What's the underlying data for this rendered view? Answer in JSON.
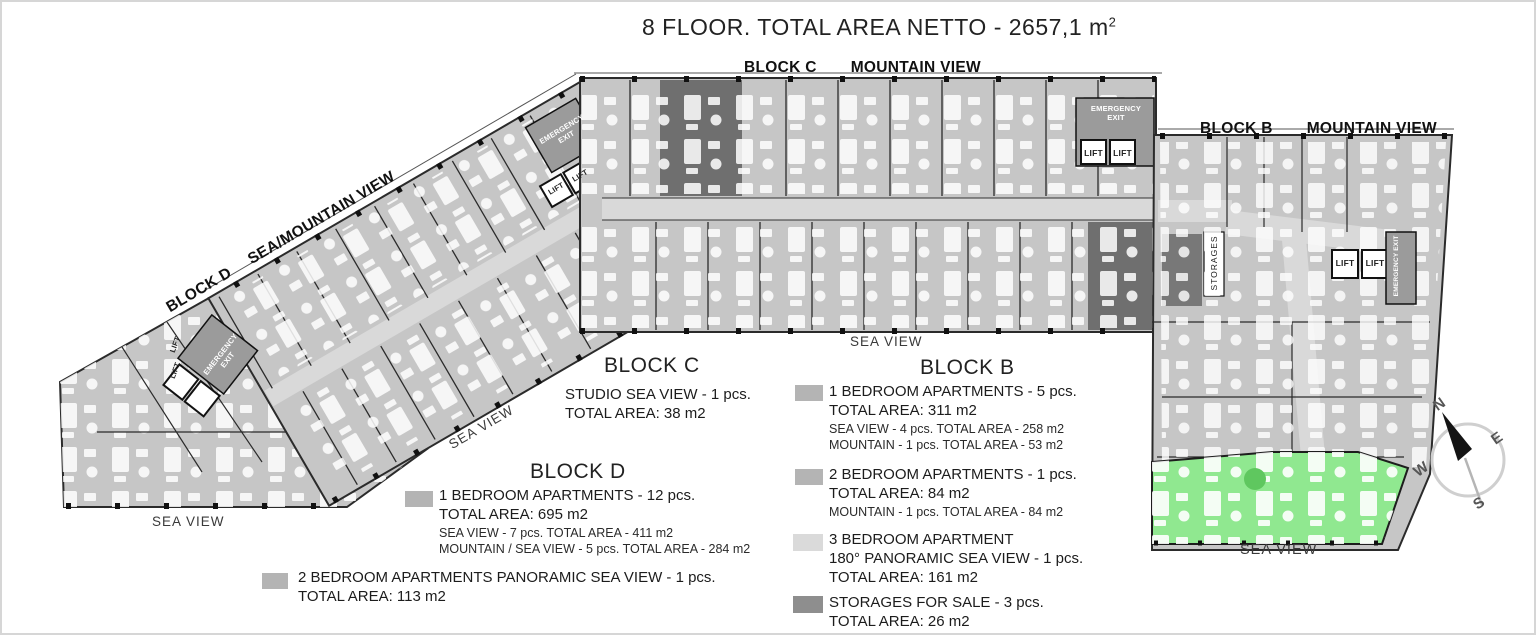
{
  "title": {
    "text": "8 FLOOR. TOTAL AREA NETTO - 2657,1 m",
    "sup": "2"
  },
  "plan": {
    "block_c_label": "BLOCK C",
    "block_c_view": "MOUNTAIN VIEW",
    "block_b_label": "BLOCK B",
    "block_b_view": "MOUNTAIN VIEW",
    "block_d_label": "BLOCK D",
    "block_d_view": "SEA/MOUNTAIN VIEW",
    "sea_view": "SEA VIEW",
    "emergency_exit": "EMERGENCY EXIT",
    "lift": "LIFT",
    "storages": "STORAGES"
  },
  "compass": {
    "n": "N",
    "e": "E",
    "s": "S",
    "w": "W"
  },
  "legends": {
    "block_c": {
      "title": "BLOCK C",
      "line1": "STUDIO SEA VIEW - 1 pcs.",
      "line2": "TOTAL AREA: 38 m2"
    },
    "block_d": {
      "title": "BLOCK D",
      "items": [
        {
          "swatch": "#b4b4b4",
          "line1": "1 BEDROOM APARTMENTS - 12 pcs.",
          "line2": "TOTAL AREA: 695 m2",
          "sub1": "SEA VIEW - 7 pcs. TOTAL AREA - 411 m2",
          "sub2": "MOUNTAIN / SEA VIEW - 5 pcs. TOTAL AREA - 284 m2"
        },
        {
          "swatch": "#b4b4b4",
          "line1": "2 BEDROOM APARTMENTS PANORAMIC SEA VIEW - 1 pcs.",
          "line2": "TOTAL AREA: 113 m2"
        }
      ]
    },
    "block_b": {
      "title": "BLOCK B",
      "items": [
        {
          "swatch": "#b4b4b4",
          "line1": "1 BEDROOM APARTMENTS - 5 pcs.",
          "line2": "TOTAL AREA: 311 m2",
          "sub1": "SEA VIEW - 4 pcs. TOTAL AREA - 258 m2",
          "sub2": "MOUNTAIN - 1 pcs. TOTAL AREA - 53 m2"
        },
        {
          "swatch": "#b4b4b4",
          "line1": "2 BEDROOM APARTMENTS - 1 pcs.",
          "line2": "TOTAL AREA: 84 m2",
          "sub1": "MOUNTAIN - 1 pcs. TOTAL AREA - 84 m2"
        },
        {
          "swatch": "#dadada",
          "line1": "3 BEDROOM APARTMENT",
          "line1b": "180° PANORAMIC SEA VIEW - 1 pcs.",
          "line2": "TOTAL AREA: 161 m2"
        },
        {
          "swatch": "#8e8e8e",
          "line1": "STORAGES FOR SALE - 3 pcs.",
          "line2": "TOTAL AREA: 26 m2"
        }
      ]
    }
  },
  "colors": {
    "unit": "#c6c6c6",
    "corridor": "#d9d9d9",
    "dark_unit": "#6f6f6f",
    "stairwell": "#9b9b9b",
    "highlight_apartment": "#90e890"
  }
}
